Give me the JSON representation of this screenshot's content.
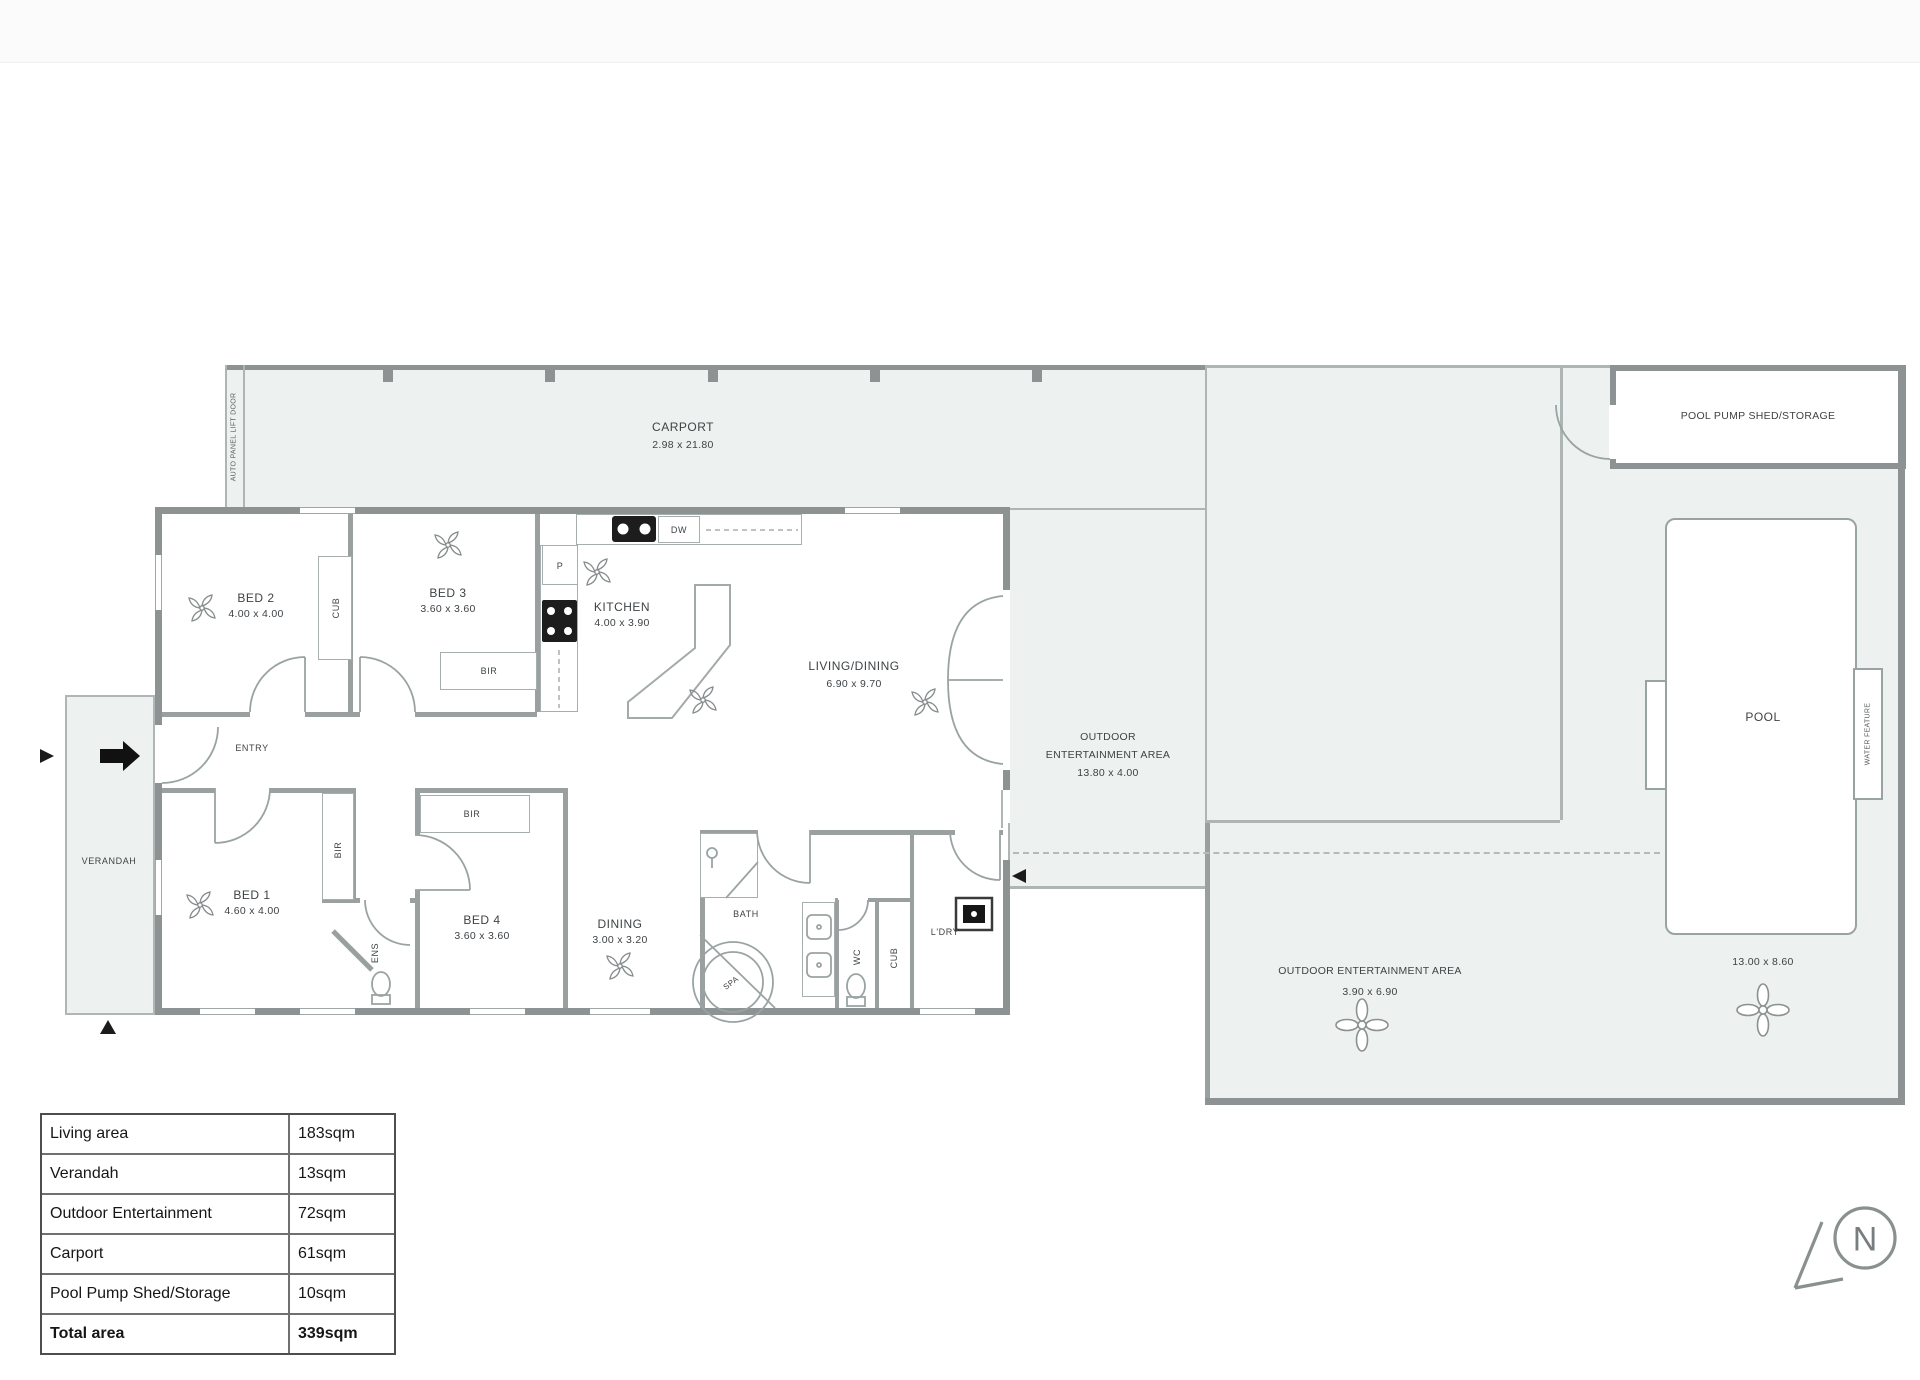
{
  "labels": {
    "carport": {
      "name": "CARPORT",
      "dims": "2.98 x 21.80"
    },
    "auto_door": "AUTO PANEL LIFT DOOR",
    "verandah": "VERANDAH",
    "entry": "ENTRY",
    "bed1": {
      "name": "BED 1",
      "dims": "4.60 x 4.00"
    },
    "bed2": {
      "name": "BED 2",
      "dims": "4.00 x 4.00"
    },
    "bed3": {
      "name": "BED 3",
      "dims": "3.60 x 3.60"
    },
    "bed4": {
      "name": "BED 4",
      "dims": "3.60 x 3.60"
    },
    "kitchen": {
      "name": "KITCHEN",
      "dims": "4.00 x 3.90"
    },
    "living": {
      "name": "LIVING/DINING",
      "dims": "6.90 x 9.70"
    },
    "dining": {
      "name": "DINING",
      "dims": "3.00 x 3.20"
    },
    "bath": "BATH",
    "spa": "SPA",
    "wc": "WC",
    "ens": "ENS",
    "cub": "CUB",
    "bir": "BIR",
    "ldry": "L'DRY",
    "pantry": "P",
    "dw": "DW",
    "oea1": {
      "l1": "OUTDOOR",
      "l2": "ENTERTAINMENT AREA",
      "l3": "13.80 x 4.00"
    },
    "oea2": {
      "l1": "OUTDOOR ENTERTAINMENT AREA",
      "l2": "3.90 x 6.90"
    },
    "pool": {
      "name": "POOL",
      "dims": "13.00 x 8.60"
    },
    "shed": "POOL PUMP SHED/STORAGE",
    "water_feature": "WATER FEATURE",
    "compass_n": "N"
  },
  "area_table": {
    "rows": [
      {
        "label": "Living area",
        "value": "183sqm"
      },
      {
        "label": "Verandah",
        "value": "13sqm"
      },
      {
        "label": "Outdoor Entertainment",
        "value": "72sqm"
      },
      {
        "label": "Carport",
        "value": "61sqm"
      },
      {
        "label": "Pool Pump Shed/Storage",
        "value": "10sqm"
      },
      {
        "label": "Total area",
        "value": "339sqm"
      }
    ]
  },
  "icons": {
    "ac_fan": "pinwheel-fan",
    "garden_fan": "4-petal-flower",
    "north": "N-compass-arrow",
    "entry_arrow": "solid-right-arrow"
  },
  "colors": {
    "wall": "#8d9293",
    "area_fill": "#edf1ef",
    "text": "#3e4346"
  }
}
